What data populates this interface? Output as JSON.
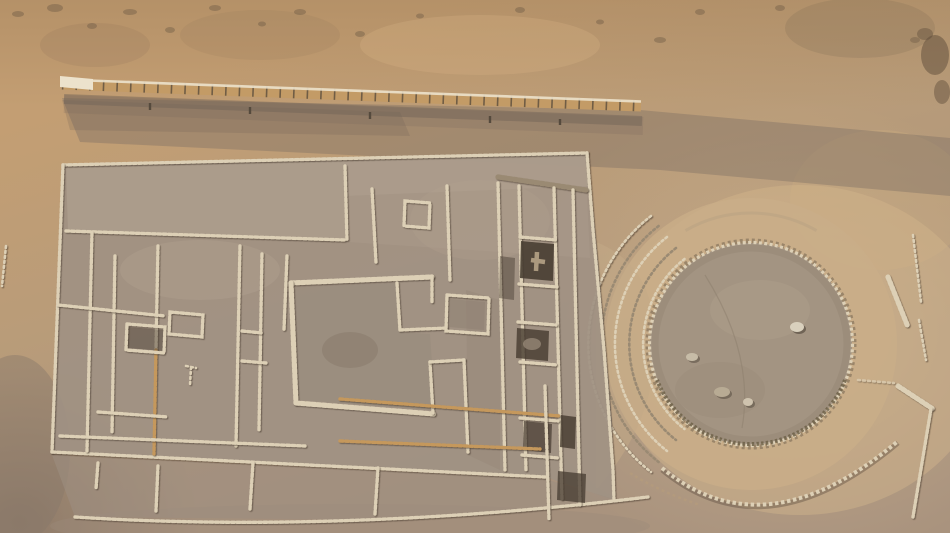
{
  "scene": {
    "type": "aerial-photograph",
    "description": "Top-down aerial view of an excavated desert archaeological complex: a large rectangular stone-walled compound with nested rooms and a central square plaza on the left, dark excavated pits along its right wing, fanned arc steps leading to a sunken circular plaza ringed with stones on the right, a long slatted fence crossing the sand above, scattered wall fragments and loose stones.",
    "features": [
      "perimeter-fence",
      "rectangular-compound",
      "central-square-plaza",
      "excavated-pits",
      "arc-steps",
      "sunken-circular-plaza",
      "outer-arc-wall",
      "wall-fragments",
      "loose-stones"
    ]
  },
  "palette": {
    "sand_top": "#c39e73",
    "sand_mid": "#b99c79",
    "sand_low": "#a9937e",
    "sand_bright": "#d2b58c",
    "slope_shadow": "#7e7063",
    "compound_floor": "#a09183",
    "compound_light": "#b4a593",
    "plaza_floor": "#a39482",
    "ring_sand": "#c9ae88",
    "stone_light": "#ddd0b6",
    "stone_dark": "#9a8a73",
    "stone_orange": "#c5985c",
    "pit": "#463b30",
    "fence_wood": "#c39b66",
    "fence_slat": "#54483b",
    "fence_light": "#ece2cc",
    "rock": "#6d5a45"
  }
}
